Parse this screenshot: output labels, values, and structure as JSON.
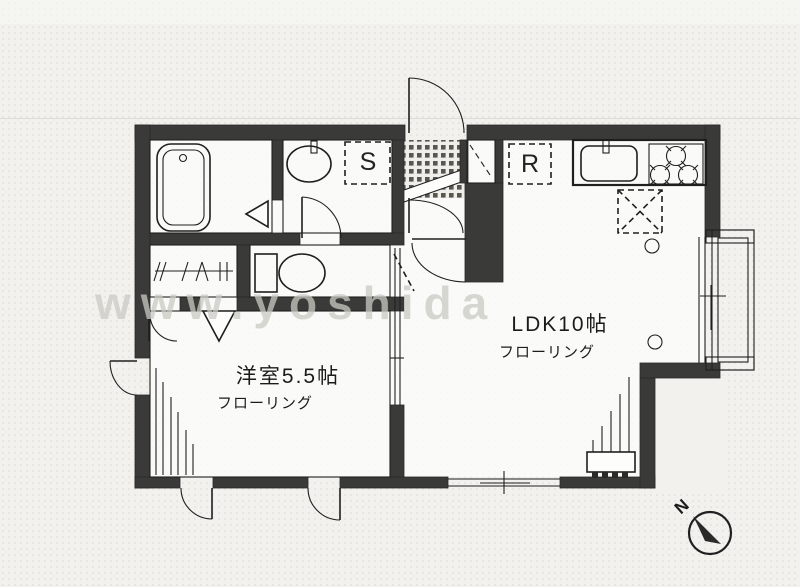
{
  "floorplan": {
    "watermark": "www.yoshida",
    "compass": {
      "label": "N"
    },
    "rooms": {
      "ldk": {
        "label": "LDK10帖",
        "flooring": "フローリング"
      },
      "western": {
        "label": "洋室5.5帖",
        "flooring": "フローリング"
      }
    },
    "markers": {
      "storage": "S",
      "refrigerator": "R"
    },
    "colors": {
      "wall": "#3a3a38",
      "line": "#1f1f1f",
      "paper": "#f2f1ee",
      "floor": "#fdfdfc",
      "watermark": "#cbcac4"
    }
  }
}
